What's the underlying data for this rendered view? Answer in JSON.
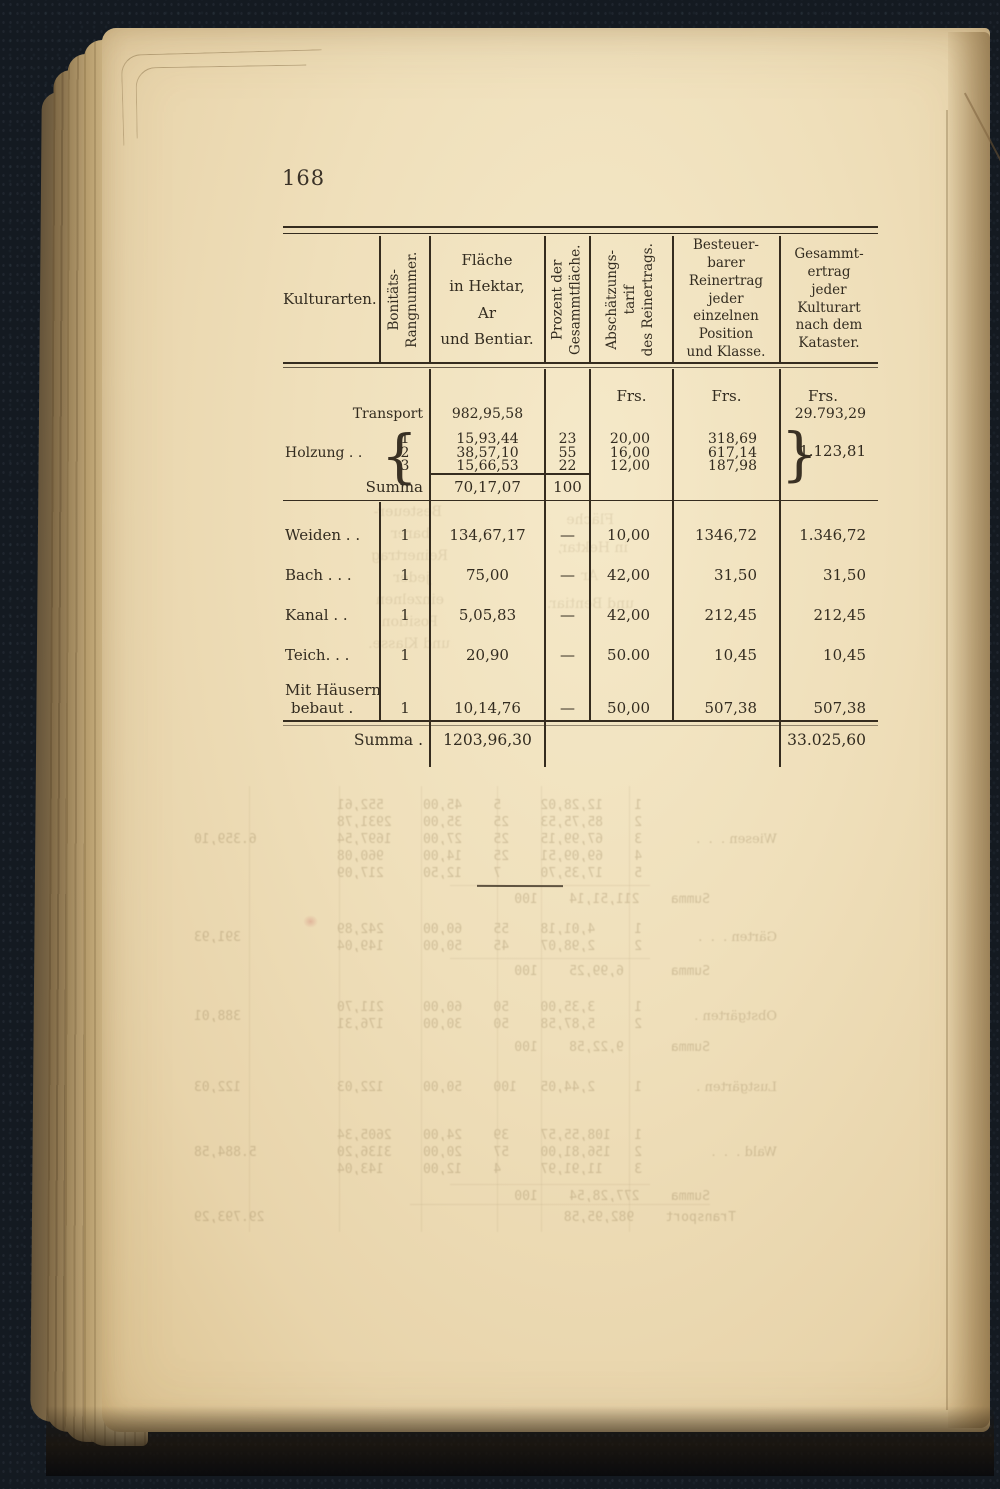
{
  "page": {
    "number": "168"
  },
  "table": {
    "headers": {
      "kulturarten": "Kulturarten.",
      "bonitaet_lines": [
        "Bonitäts-",
        "Rangnummer."
      ],
      "flaeche_lines": [
        "Fläche",
        "in Hektar,",
        "Ar",
        "und Bentiar."
      ],
      "prozent_lines": [
        "Prozent der",
        "Gesammtfläche."
      ],
      "tarif_lines": [
        "Abschätzungs-",
        "tarif",
        "des Reinertrags."
      ],
      "besteuer_lines": [
        "Besteuer-",
        "barer",
        "Reinertrag",
        "jeder",
        "einzelnen",
        "Position",
        "und Klasse."
      ],
      "gesammt_lines": [
        "Gesammt-",
        "ertrag",
        "jeder",
        "Kulturart",
        "nach dem",
        "Kataster."
      ]
    },
    "currency": {
      "frs5": "Frs.",
      "frs6": "Frs.",
      "frs7": "Frs."
    },
    "section1": {
      "transport_label": "Transport",
      "transport_flaeche": "982,95,58",
      "transport_gesammt": "29.793,29",
      "holzung_label": "Holzung .   .",
      "brace_left": "{",
      "brace_right": "}",
      "rows": [
        {
          "rang": "1",
          "flaeche": "15,93,44",
          "prozent": "23",
          "tarif": "20,00",
          "reinertrag": "318,69"
        },
        {
          "rang": "2",
          "flaeche": "38,57,10",
          "prozent": "55",
          "tarif": "16,00",
          "reinertrag": "617,14"
        },
        {
          "rang": "3",
          "flaeche": "15,66,53",
          "prozent": "22",
          "tarif": "12,00",
          "reinertrag": "187,98"
        }
      ],
      "brace_total": "1.123,81",
      "summa_label": "Summa",
      "summa_flaeche": "70,17,07",
      "summa_prozent": "100"
    },
    "section2": {
      "rows": [
        {
          "label": "Weiden .   .",
          "rang": "1",
          "flaeche": "134,67,17",
          "prozent": "—",
          "tarif": "10,00",
          "reinertrag": "1346,72",
          "gesammt": "1.346,72"
        },
        {
          "label": "Bach .   .   .",
          "rang": "1",
          "flaeche": "75,00",
          "prozent": "—",
          "tarif": "42,00",
          "reinertrag": "31,50",
          "gesammt": "31,50"
        },
        {
          "label": "Kanal   .   .",
          "rang": "1",
          "flaeche": "5,05,83",
          "prozent": "—",
          "tarif": "42,00",
          "reinertrag": "212,45",
          "gesammt": "212,45"
        },
        {
          "label": "Teich.   .   .",
          "rang": "1",
          "flaeche": "20,90",
          "prozent": "—",
          "tarif": "50.00",
          "reinertrag": "10,45",
          "gesammt": "10,45"
        }
      ],
      "haeuser_label1": "Mit Häusern",
      "haeuser_label2": "bebaut      .",
      "haeuser_row": {
        "rang": "1",
        "flaeche": "10,14,76",
        "prozent": "—",
        "tarif": "50,00",
        "reinertrag": "507,38",
        "gesammt": "507,38"
      },
      "summa_label": "Summa .",
      "summa_flaeche": "1203,96,30",
      "summa_gesammt": "33.025,60"
    }
  },
  "bleedthrough": {
    "num_rows": [
      {
        "top": 16,
        "left": 300,
        "text": " 1    12,28,02     5    45,00     552,61"
      },
      {
        "top": 33,
        "left": 300,
        "text": " 2    85,75,53    25    35,00    2931,78"
      },
      {
        "top": 50,
        "left": 300,
        "text": " 3    67,99,15    25    27,00    1697,54"
      },
      {
        "top": 67,
        "left": 300,
        "text": " 4    69,09,51    25    14,00     960,08"
      },
      {
        "top": 84,
        "left": 300,
        "text": " 5    17,35,70     7    12,50     217,09"
      },
      {
        "top": 110,
        "left": 240,
        "text": "Summa    211,51,14    100"
      },
      {
        "top": 50,
        "left": 173,
        "serif": true,
        "text": "Wiesen .  .  ."
      },
      {
        "top": 50,
        "right": 84,
        "text": "6.359,10"
      },
      {
        "top": 140,
        "left": 300,
        "text": " 1     4,01,18    55    60,00     242,89"
      },
      {
        "top": 157,
        "left": 300,
        "text": " 2     2,98,07    45    50,00     149,04"
      },
      {
        "top": 182,
        "left": 240,
        "text": "Summa      6,99,25    100"
      },
      {
        "top": 148,
        "left": 173,
        "serif": true,
        "text": "Gärten .  .  ."
      },
      {
        "top": 148,
        "right": 84,
        "text": "391,93"
      },
      {
        "top": 218,
        "left": 300,
        "text": " 1     3,35,00    50    60,00     211,70"
      },
      {
        "top": 235,
        "left": 300,
        "text": " 2     5,87,58    50    30,00     176,31"
      },
      {
        "top": 258,
        "left": 240,
        "text": "Summa      9,22,58    100"
      },
      {
        "top": 227,
        "left": 173,
        "serif": true,
        "text": "Obstgärten ."
      },
      {
        "top": 227,
        "right": 84,
        "text": "388,01"
      },
      {
        "top": 298,
        "left": 300,
        "text": " 1     2,44,05   100    50,00     122,03"
      },
      {
        "top": 298,
        "left": 173,
        "serif": true,
        "text": "Lustgärten ."
      },
      {
        "top": 298,
        "right": 84,
        "text": "122,03"
      },
      {
        "top": 346,
        "left": 300,
        "text": " 1   108,55,57    39    24,00    2605,34"
      },
      {
        "top": 363,
        "left": 300,
        "text": " 2   156,81,00    57    20,00    3136,20"
      },
      {
        "top": 380,
        "left": 300,
        "text": " 3    11,91,97     4    12,00     143,04"
      },
      {
        "top": 407,
        "left": 240,
        "text": "Summa    277,28,54    100"
      },
      {
        "top": 363,
        "left": 173,
        "serif": true,
        "text": "Wald .  .  ."
      },
      {
        "top": 363,
        "right": 84,
        "text": "5.884,58"
      },
      {
        "top": 428,
        "left": 214,
        "text": "Transport    982,95,58"
      },
      {
        "top": 428,
        "right": 84,
        "text": "29.793,29"
      }
    ],
    "head_rows": [
      {
        "top": 14,
        "left": 336,
        "text": "Fläche"
      },
      {
        "top": 42,
        "left": 322,
        "text": "in Hektar,"
      },
      {
        "top": 70,
        "left": 352,
        "text": "Ar"
      },
      {
        "top": 98,
        "left": 316,
        "text": "und Bentiar."
      },
      {
        "top": 6,
        "left": 508,
        "text": "Besteuer-"
      },
      {
        "top": 28,
        "left": 520,
        "text": "barer"
      },
      {
        "top": 50,
        "left": 502,
        "text": "Reinertrag"
      },
      {
        "top": 72,
        "left": 520,
        "text": "jeder"
      },
      {
        "top": 94,
        "left": 506,
        "text": "einzelnen"
      },
      {
        "top": 116,
        "left": 512,
        "text": "Position"
      },
      {
        "top": 138,
        "left": 500,
        "text": "und Klasse."
      }
    ]
  }
}
